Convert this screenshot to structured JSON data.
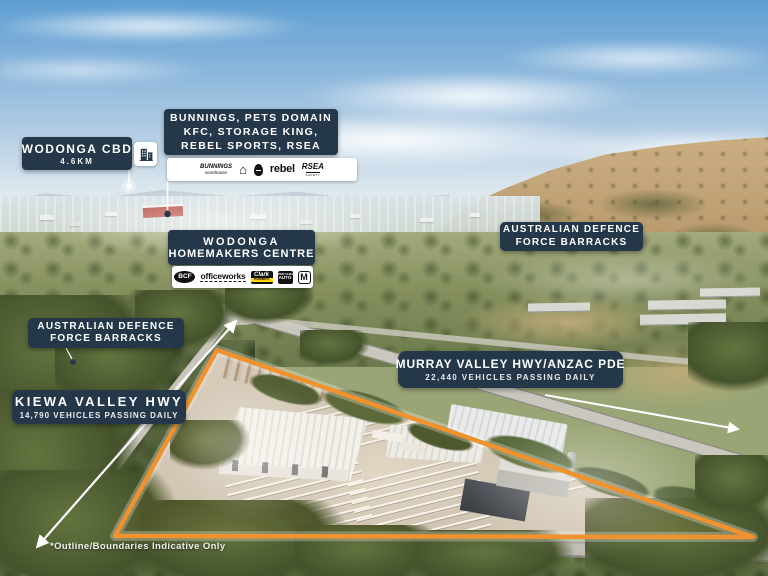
{
  "colors": {
    "panel_navy": "#24384A",
    "boundary_orange": "#F0922D",
    "text_white": "#FFFFFF"
  },
  "labels": {
    "wodonga_cbd": {
      "title": "WODONGA CBD",
      "distance": "4.6KM"
    },
    "retail_precinct": {
      "line1": "BUNNINGS, PETS DOMAIN",
      "line2": "KFC, STORAGE KING,",
      "line3": "REBEL SPORTS, RSEA",
      "logos": {
        "bunnings_top": "BUNNINGS",
        "bunnings_bottom": "warehouse",
        "pets_domain": "Pets Domain",
        "kfc": "KFC",
        "rebel": "rebel",
        "rsea_top": "RSEA",
        "rsea_bottom": "SAFETY"
      }
    },
    "homemakers_centre": {
      "line1": "WODONGA",
      "line2": "HOMEMAKERS CENTRE",
      "logos": {
        "bcf": "BCF",
        "officeworks": "officeworks",
        "clark_top": "Clark",
        "clark_bottom": "RUBBER",
        "supercheap_top": "SUPER CHEAP",
        "supercheap_bottom": "AUTO",
        "mcdonalds": "M"
      }
    },
    "adf_barracks_right": {
      "line1": "AUSTRALIAN DEFENCE",
      "line2": "FORCE BARRACKS"
    },
    "adf_barracks_left": {
      "line1": "AUSTRALIAN DEFENCE",
      "line2": "FORCE BARRACKS"
    },
    "murray_valley": {
      "title": "MURRAY VALLEY HWY/ANZAC PDE",
      "subtitle": "22,440 VEHICLES PASSING DAILY"
    },
    "kiewa_valley": {
      "title": "KIEWA VALLEY HWY",
      "subtitle": "14,790 VEHICLES PASSING DAILY"
    }
  },
  "footnote": "*Outline/Boundaries Indicative Only"
}
